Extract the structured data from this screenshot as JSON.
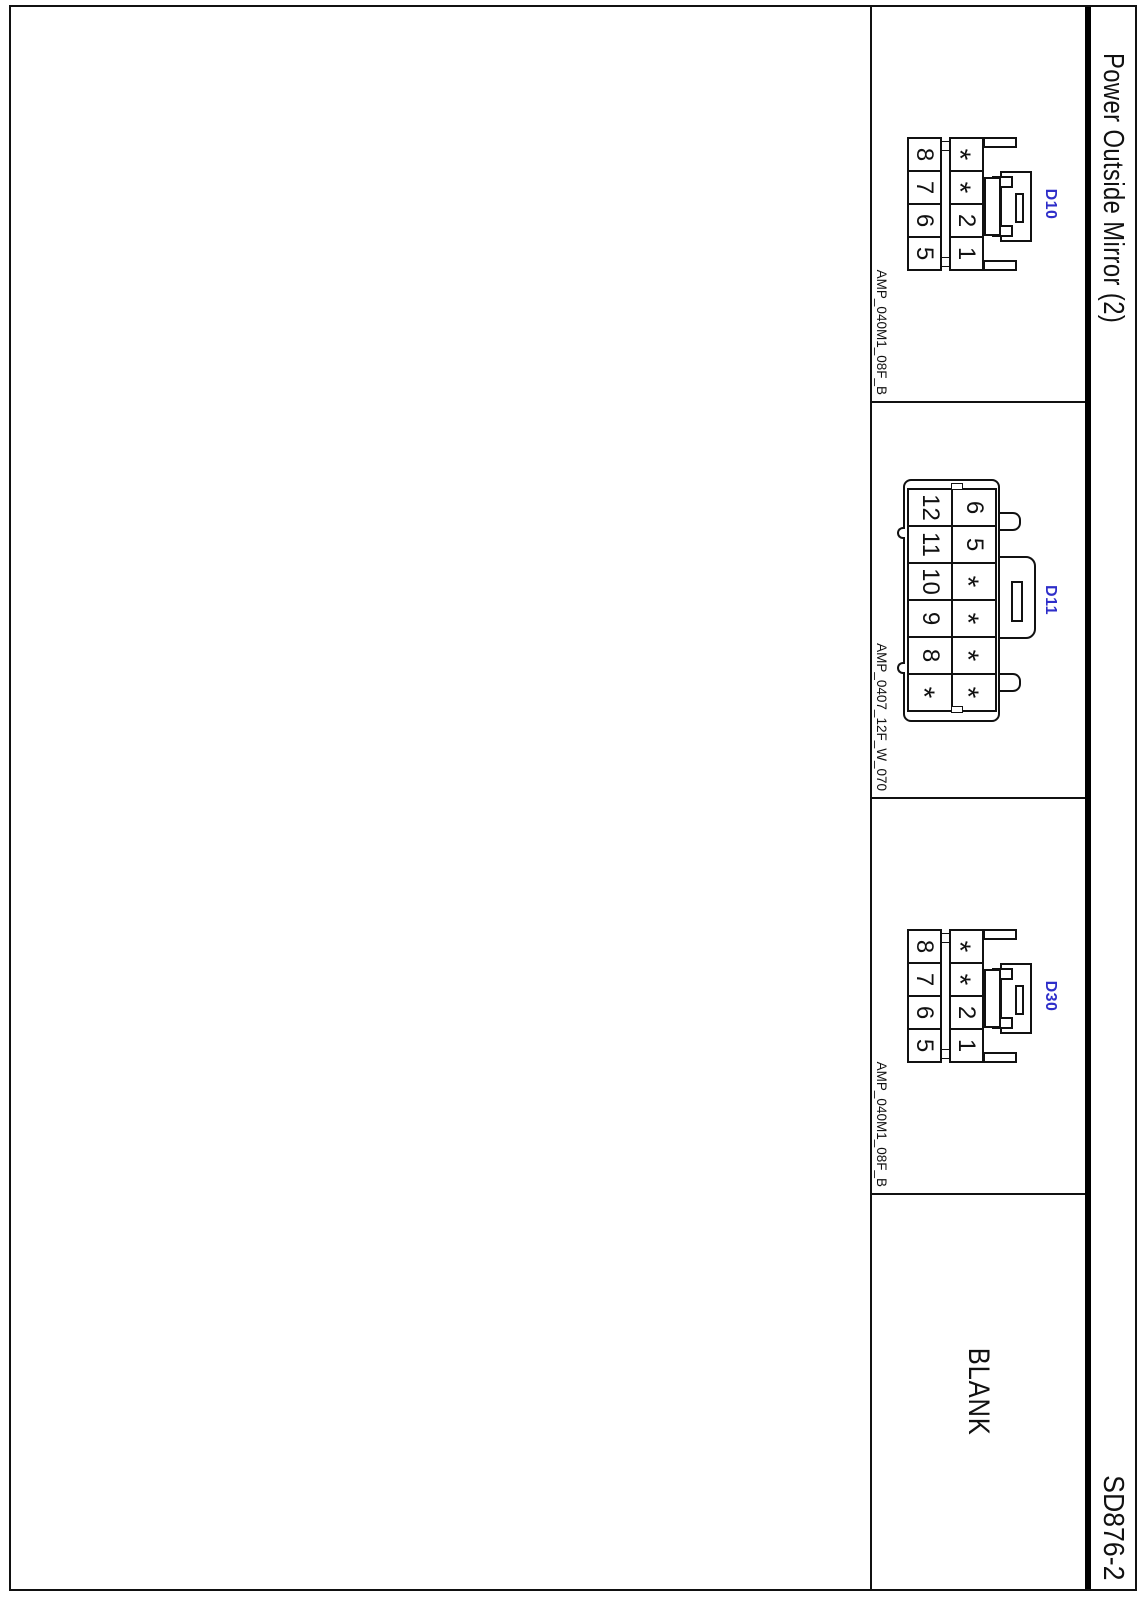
{
  "page": {
    "title": "Power Outside Mirror (2)",
    "sheet_code": "SD876-2"
  },
  "connectors": {
    "d10": {
      "id": "D10",
      "part_code": "AMP_040M1_08F_B",
      "top_row": [
        "*",
        "*",
        "2",
        "1"
      ],
      "bottom_row": [
        "8",
        "7",
        "6",
        "5"
      ]
    },
    "d11": {
      "id": "D11",
      "part_code": "AMP_0407_12F_W_070",
      "top_row": [
        "6",
        "5",
        "*",
        "*",
        "*",
        "*"
      ],
      "bottom_row": [
        "12",
        "11",
        "10",
        "9",
        "8",
        "*"
      ]
    },
    "d30": {
      "id": "D30",
      "part_code": "AMP_040M1_08F_B",
      "top_row": [
        "*",
        "*",
        "2",
        "1"
      ],
      "bottom_row": [
        "8",
        "7",
        "6",
        "5"
      ]
    },
    "blank": {
      "label": "BLANK"
    }
  },
  "colors": {
    "connector_id_blue": "#2E2EC9",
    "line_black": "#111111"
  }
}
